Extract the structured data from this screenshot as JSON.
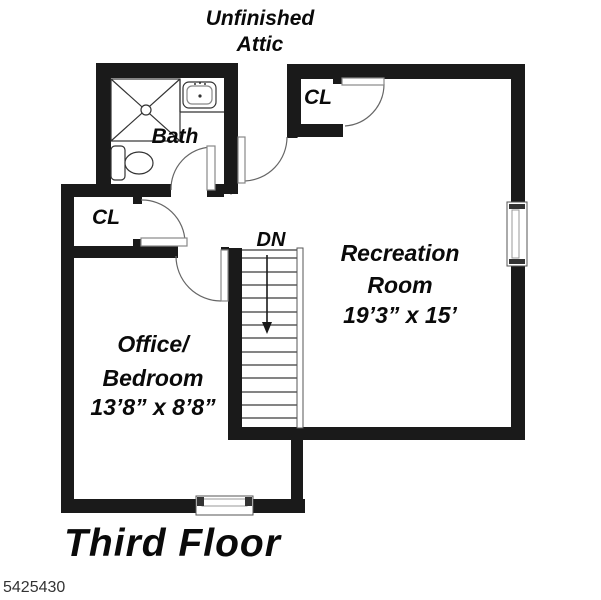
{
  "colors": {
    "background": "#ffffff",
    "wall": "#1a1a1a",
    "text": "#0a0a0a",
    "muted_text": "#333333",
    "thin_line": "#555555"
  },
  "attic": {
    "label_line1": "Unfinished",
    "label_line2": "Attic"
  },
  "rooms": {
    "bath": {
      "label": "Bath"
    },
    "closet_upper_right": {
      "label": "CL"
    },
    "closet_left": {
      "label": "CL"
    },
    "recreation_room": {
      "label_line1": "Recreation",
      "label_line2": "Room",
      "dimensions": "19’3” x 15’"
    },
    "office_bedroom": {
      "label_line1": "Office/",
      "label_line2": "Bedroom",
      "dimensions": "13’8” x 8’8”"
    }
  },
  "stairs": {
    "label": "DN"
  },
  "footer": {
    "title": "Third Floor",
    "listing_id": "5425430"
  },
  "icons": [
    "shower-icon",
    "sink-icon",
    "toilet-icon",
    "stairs-down-arrow-icon",
    "door-swing-icon",
    "window-icon"
  ]
}
